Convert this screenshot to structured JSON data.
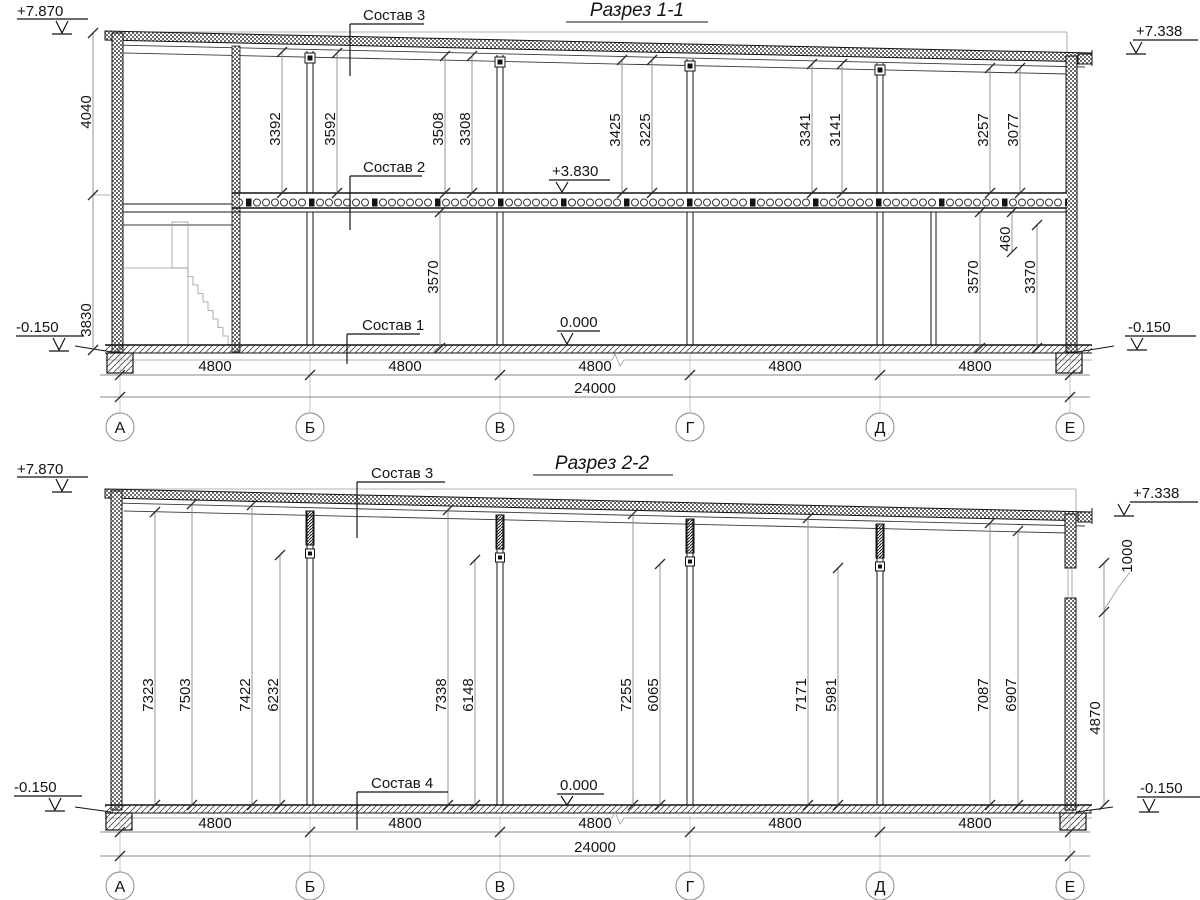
{
  "s1": {
    "title": "Разрез 1-1",
    "sostav3": "Состав 3",
    "sostav2": "Состав 2",
    "sostav1": "Состав 1",
    "elev_tl": "+7.870",
    "elev_tr": "+7.338",
    "elev_bl": "-0.150",
    "elev_br": "-0.150",
    "elev_floor": "+3.830",
    "elev_zero": "0.000",
    "dim_left_top": "4040",
    "dim_left_bot": "3830",
    "h": [
      "3392",
      "3592",
      "3508",
      "3308",
      "3425",
      "3225",
      "3341",
      "3141",
      "3257",
      "3077"
    ],
    "g": [
      "3570",
      "460",
      "3570",
      "3370"
    ],
    "bays": [
      "4800",
      "4800",
      "4800",
      "4800",
      "4800"
    ],
    "total": "24000",
    "axes": [
      "А",
      "Б",
      "В",
      "Г",
      "Д",
      "Е"
    ]
  },
  "s2": {
    "title": "Разрез 2-2",
    "sostav3": "Состав 3",
    "sostav4": "Состав 4",
    "elev_tl": "+7.870",
    "elev_tr": "+7.338",
    "elev_bl": "-0.150",
    "elev_br": "-0.150",
    "elev_zero": "0.000",
    "h": [
      "7323",
      "7503",
      "7422",
      "6232",
      "7338",
      "6148",
      "7255",
      "6065",
      "7171",
      "5981",
      "7087",
      "6907"
    ],
    "dim_window": "1000",
    "dim_right": "4870",
    "bays": [
      "4800",
      "4800",
      "4800",
      "4800",
      "4800"
    ],
    "total": "24000",
    "axes": [
      "А",
      "Б",
      "В",
      "Г",
      "Д",
      "Е"
    ]
  }
}
